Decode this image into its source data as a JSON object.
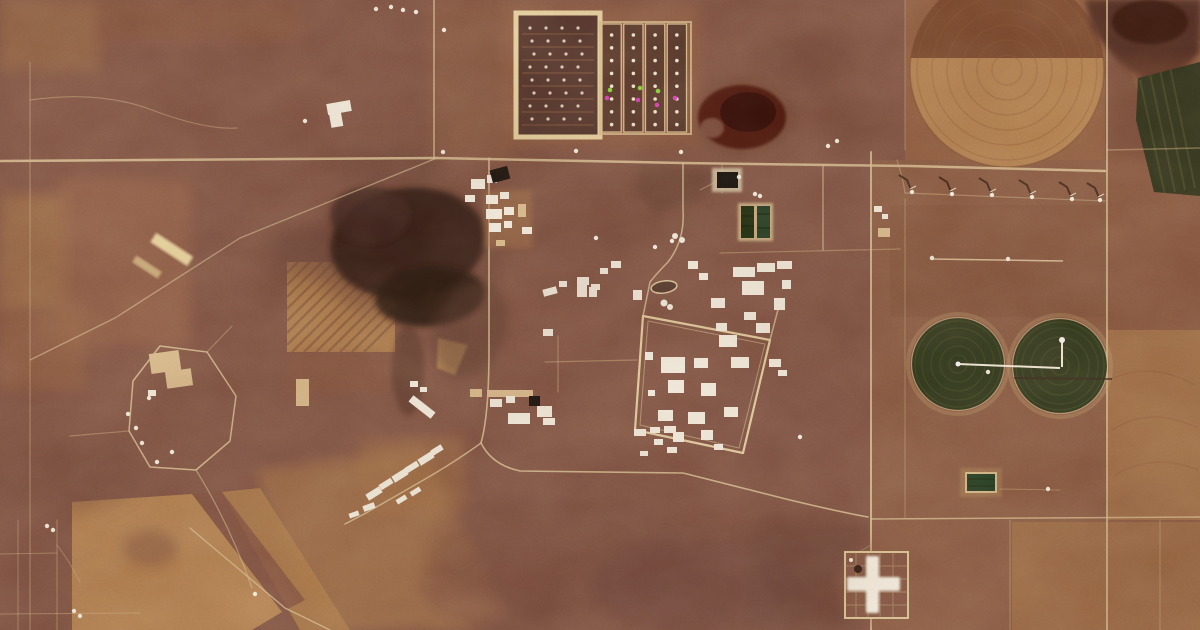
{
  "scene": {
    "title": "Satellite view of a secured industrial plant amid High Plains farmland",
    "description": "Overhead satellite photograph: central high-security plant complex with white buildings and fenced compound, cattle feedlot pens at top, dark playa lakes, center-pivot irrigation circles (dark green crops and fallow tan), a row of wind turbines, section-line roads, and a cross-shaped compound at lower right. No text or UI elements are present in the image.",
    "palette": {
      "base": "#7d574a",
      "base_dark": "#6b4a40",
      "field_tan": "#a97e53",
      "field_tan_bright": "#bb8f5e",
      "field_pink": "#9c6c52",
      "road_light": "#dbc59c",
      "mottle_dark": "#563a32",
      "playa_dark": "#2e1d17",
      "playa_red": "#471510",
      "playa_brown": "#4a2b20",
      "crop_green": "#2b3a1f",
      "crop_green_rings": "#45562e",
      "pond_green_a": "#1b2f13",
      "pond_green_b": "#1f4026",
      "green_wedge": "#2a331d",
      "building_white": "#f4efe3",
      "building_tan": "#d9be92",
      "dark_roof": "#191511",
      "anomaly_magenta": "#e03fc4",
      "anomaly_green": "#86e03a",
      "shadow_dark": "#2f2017",
      "cross_white": "#f7f3e8"
    }
  },
  "features": {
    "buildings": [
      [
        471,
        179,
        14,
        10,
        0,
        "w"
      ],
      [
        487,
        175,
        10,
        8,
        0,
        "w"
      ],
      [
        465,
        195,
        10,
        7,
        0,
        "w"
      ],
      [
        486,
        195,
        12,
        9,
        0,
        "w"
      ],
      [
        500,
        192,
        9,
        7,
        0,
        "w"
      ],
      [
        486,
        209,
        16,
        10,
        0,
        "w"
      ],
      [
        504,
        207,
        10,
        8,
        0,
        "w"
      ],
      [
        489,
        223,
        12,
        9,
        0,
        "w"
      ],
      [
        504,
        221,
        8,
        7,
        0,
        "w"
      ],
      [
        518,
        204,
        8,
        13,
        0,
        "t"
      ],
      [
        522,
        227,
        10,
        7,
        0,
        "w"
      ],
      [
        496,
        240,
        9,
        6,
        0,
        "t"
      ],
      [
        327,
        102,
        24,
        11,
        -10,
        "w"
      ],
      [
        330,
        111,
        12,
        16,
        -10,
        "w"
      ],
      [
        543,
        288,
        14,
        7,
        -15,
        "w"
      ],
      [
        559,
        281,
        8,
        6,
        0,
        "w"
      ],
      [
        577,
        277,
        12,
        8,
        0,
        "w"
      ],
      [
        591,
        284,
        9,
        6,
        0,
        "w"
      ],
      [
        600,
        268,
        8,
        6,
        0,
        "w"
      ],
      [
        611,
        261,
        10,
        7,
        0,
        "w"
      ],
      [
        577,
        281,
        10,
        16,
        0,
        "w"
      ],
      [
        589,
        287,
        8,
        10,
        0,
        "w"
      ],
      [
        543,
        329,
        10,
        7,
        0,
        "w"
      ],
      [
        633,
        290,
        9,
        10,
        0,
        "w"
      ],
      [
        733,
        267,
        22,
        10,
        0,
        "w"
      ],
      [
        757,
        263,
        18,
        9,
        0,
        "w"
      ],
      [
        777,
        261,
        15,
        8,
        0,
        "w"
      ],
      [
        688,
        261,
        10,
        8,
        0,
        "w"
      ],
      [
        699,
        273,
        9,
        7,
        0,
        "w"
      ],
      [
        711,
        298,
        14,
        10,
        0,
        "w"
      ],
      [
        742,
        281,
        22,
        14,
        0,
        "w"
      ],
      [
        744,
        312,
        12,
        8,
        0,
        "w"
      ],
      [
        774,
        298,
        11,
        12,
        0,
        "w"
      ],
      [
        782,
        280,
        9,
        9,
        0,
        "w"
      ],
      [
        756,
        323,
        14,
        10,
        0,
        "w"
      ],
      [
        716,
        323,
        11,
        8,
        0,
        "w"
      ],
      [
        661,
        357,
        24,
        16,
        0,
        "w"
      ],
      [
        694,
        358,
        14,
        10,
        0,
        "w"
      ],
      [
        719,
        335,
        18,
        12,
        0,
        "w"
      ],
      [
        731,
        357,
        18,
        11,
        0,
        "w"
      ],
      [
        668,
        380,
        16,
        13,
        0,
        "w"
      ],
      [
        701,
        383,
        15,
        13,
        0,
        "w"
      ],
      [
        658,
        410,
        15,
        11,
        0,
        "w"
      ],
      [
        688,
        412,
        17,
        12,
        0,
        "w"
      ],
      [
        724,
        407,
        14,
        10,
        0,
        "w"
      ],
      [
        701,
        430,
        12,
        10,
        0,
        "w"
      ],
      [
        673,
        432,
        11,
        10,
        0,
        "w"
      ],
      [
        645,
        352,
        8,
        8,
        0,
        "w"
      ],
      [
        648,
        390,
        7,
        6,
        0,
        "w"
      ],
      [
        714,
        444,
        9,
        6,
        0,
        "w"
      ],
      [
        769,
        359,
        12,
        8,
        0,
        "w"
      ],
      [
        778,
        370,
        9,
        6,
        0,
        "w"
      ],
      [
        487,
        390,
        46,
        7,
        0,
        "t"
      ],
      [
        490,
        399,
        12,
        8,
        0,
        "w"
      ],
      [
        506,
        396,
        9,
        7,
        0,
        "w"
      ],
      [
        537,
        406,
        15,
        11,
        0,
        "w"
      ],
      [
        508,
        413,
        22,
        11,
        0,
        "w"
      ],
      [
        543,
        418,
        12,
        7,
        0,
        "w"
      ],
      [
        470,
        389,
        12,
        8,
        0,
        "t"
      ],
      [
        408,
        403,
        28,
        8,
        38,
        "w"
      ],
      [
        410,
        381,
        8,
        6,
        0,
        "w"
      ],
      [
        420,
        387,
        7,
        5,
        0,
        "w"
      ],
      [
        366,
        490,
        16,
        7,
        -32,
        "w"
      ],
      [
        379,
        481,
        14,
        6,
        -32,
        "w"
      ],
      [
        392,
        472,
        16,
        7,
        -32,
        "w"
      ],
      [
        405,
        464,
        14,
        6,
        -32,
        "w"
      ],
      [
        418,
        455,
        16,
        7,
        -32,
        "w"
      ],
      [
        431,
        447,
        12,
        6,
        -32,
        "w"
      ],
      [
        396,
        497,
        11,
        5,
        -32,
        "w"
      ],
      [
        410,
        489,
        11,
        5,
        -32,
        "w"
      ],
      [
        363,
        504,
        12,
        6,
        -20,
        "w"
      ],
      [
        349,
        512,
        10,
        5,
        -20,
        "w"
      ],
      [
        634,
        429,
        12,
        7,
        0,
        "w"
      ],
      [
        650,
        427,
        10,
        6,
        0,
        "w"
      ],
      [
        664,
        426,
        12,
        7,
        0,
        "w"
      ],
      [
        654,
        439,
        9,
        6,
        0,
        "w"
      ],
      [
        667,
        447,
        10,
        6,
        0,
        "w"
      ],
      [
        640,
        451,
        8,
        5,
        0,
        "w"
      ],
      [
        874,
        206,
        8,
        6,
        0,
        "w"
      ],
      [
        878,
        228,
        12,
        9,
        0,
        "t"
      ],
      [
        882,
        214,
        6,
        5,
        0,
        "w"
      ],
      [
        150,
        352,
        30,
        20,
        -8,
        "t"
      ],
      [
        166,
        370,
        26,
        17,
        -8,
        "t"
      ],
      [
        148,
        390,
        8,
        6,
        0,
        "w"
      ],
      [
        296,
        379,
        13,
        27,
        0,
        "t"
      ]
    ],
    "dark_roofs": [
      [
        491,
        168,
        18,
        13,
        -15
      ],
      [
        529,
        396,
        11,
        10,
        0
      ]
    ],
    "tanks": [
      [
        664,
        303,
        3.5
      ],
      [
        670,
        307,
        3
      ],
      [
        675,
        236,
        3
      ],
      [
        682,
        240,
        3
      ]
    ],
    "specks": [
      [
        376,
        9
      ],
      [
        391,
        7
      ],
      [
        403,
        10
      ],
      [
        416,
        12
      ],
      [
        444,
        30
      ],
      [
        305,
        121
      ],
      [
        443,
        152
      ],
      [
        576,
        151
      ],
      [
        681,
        152
      ],
      [
        828,
        146
      ],
      [
        837,
        141
      ],
      [
        739,
        177
      ],
      [
        755,
        194
      ],
      [
        760,
        196
      ],
      [
        800,
        437
      ],
      [
        255,
        594
      ],
      [
        74,
        611
      ],
      [
        80,
        616
      ],
      [
        47,
        526
      ],
      [
        53,
        530
      ],
      [
        932,
        258
      ],
      [
        1008,
        259
      ],
      [
        988,
        372
      ],
      [
        1048,
        489
      ],
      [
        136,
        428
      ],
      [
        149,
        398
      ],
      [
        157,
        462
      ],
      [
        172,
        452
      ],
      [
        142,
        443
      ],
      [
        128,
        414
      ],
      [
        596,
        238
      ],
      [
        655,
        247
      ],
      [
        672,
        241
      ]
    ],
    "turbines": [
      [
        912,
        192
      ],
      [
        952,
        194
      ],
      [
        992,
        195
      ],
      [
        1032,
        197
      ],
      [
        1072,
        199
      ],
      [
        1100,
        200
      ]
    ],
    "anomalies": {
      "magenta": [
        [
          607,
          98
        ],
        [
          638,
          100
        ],
        [
          657,
          105
        ],
        [
          675,
          98
        ]
      ],
      "green": [
        [
          610,
          90
        ],
        [
          640,
          88
        ],
        [
          658,
          91
        ]
      ]
    },
    "feedlot": {
      "left_pen": {
        "x": 516,
        "y": 13,
        "w": 84,
        "h": 124,
        "rows": 8,
        "cols": 4
      },
      "right_pens": {
        "x": 602,
        "y": 24,
        "w": 87,
        "h": 108,
        "lanes": 4,
        "rows": 8
      }
    }
  }
}
